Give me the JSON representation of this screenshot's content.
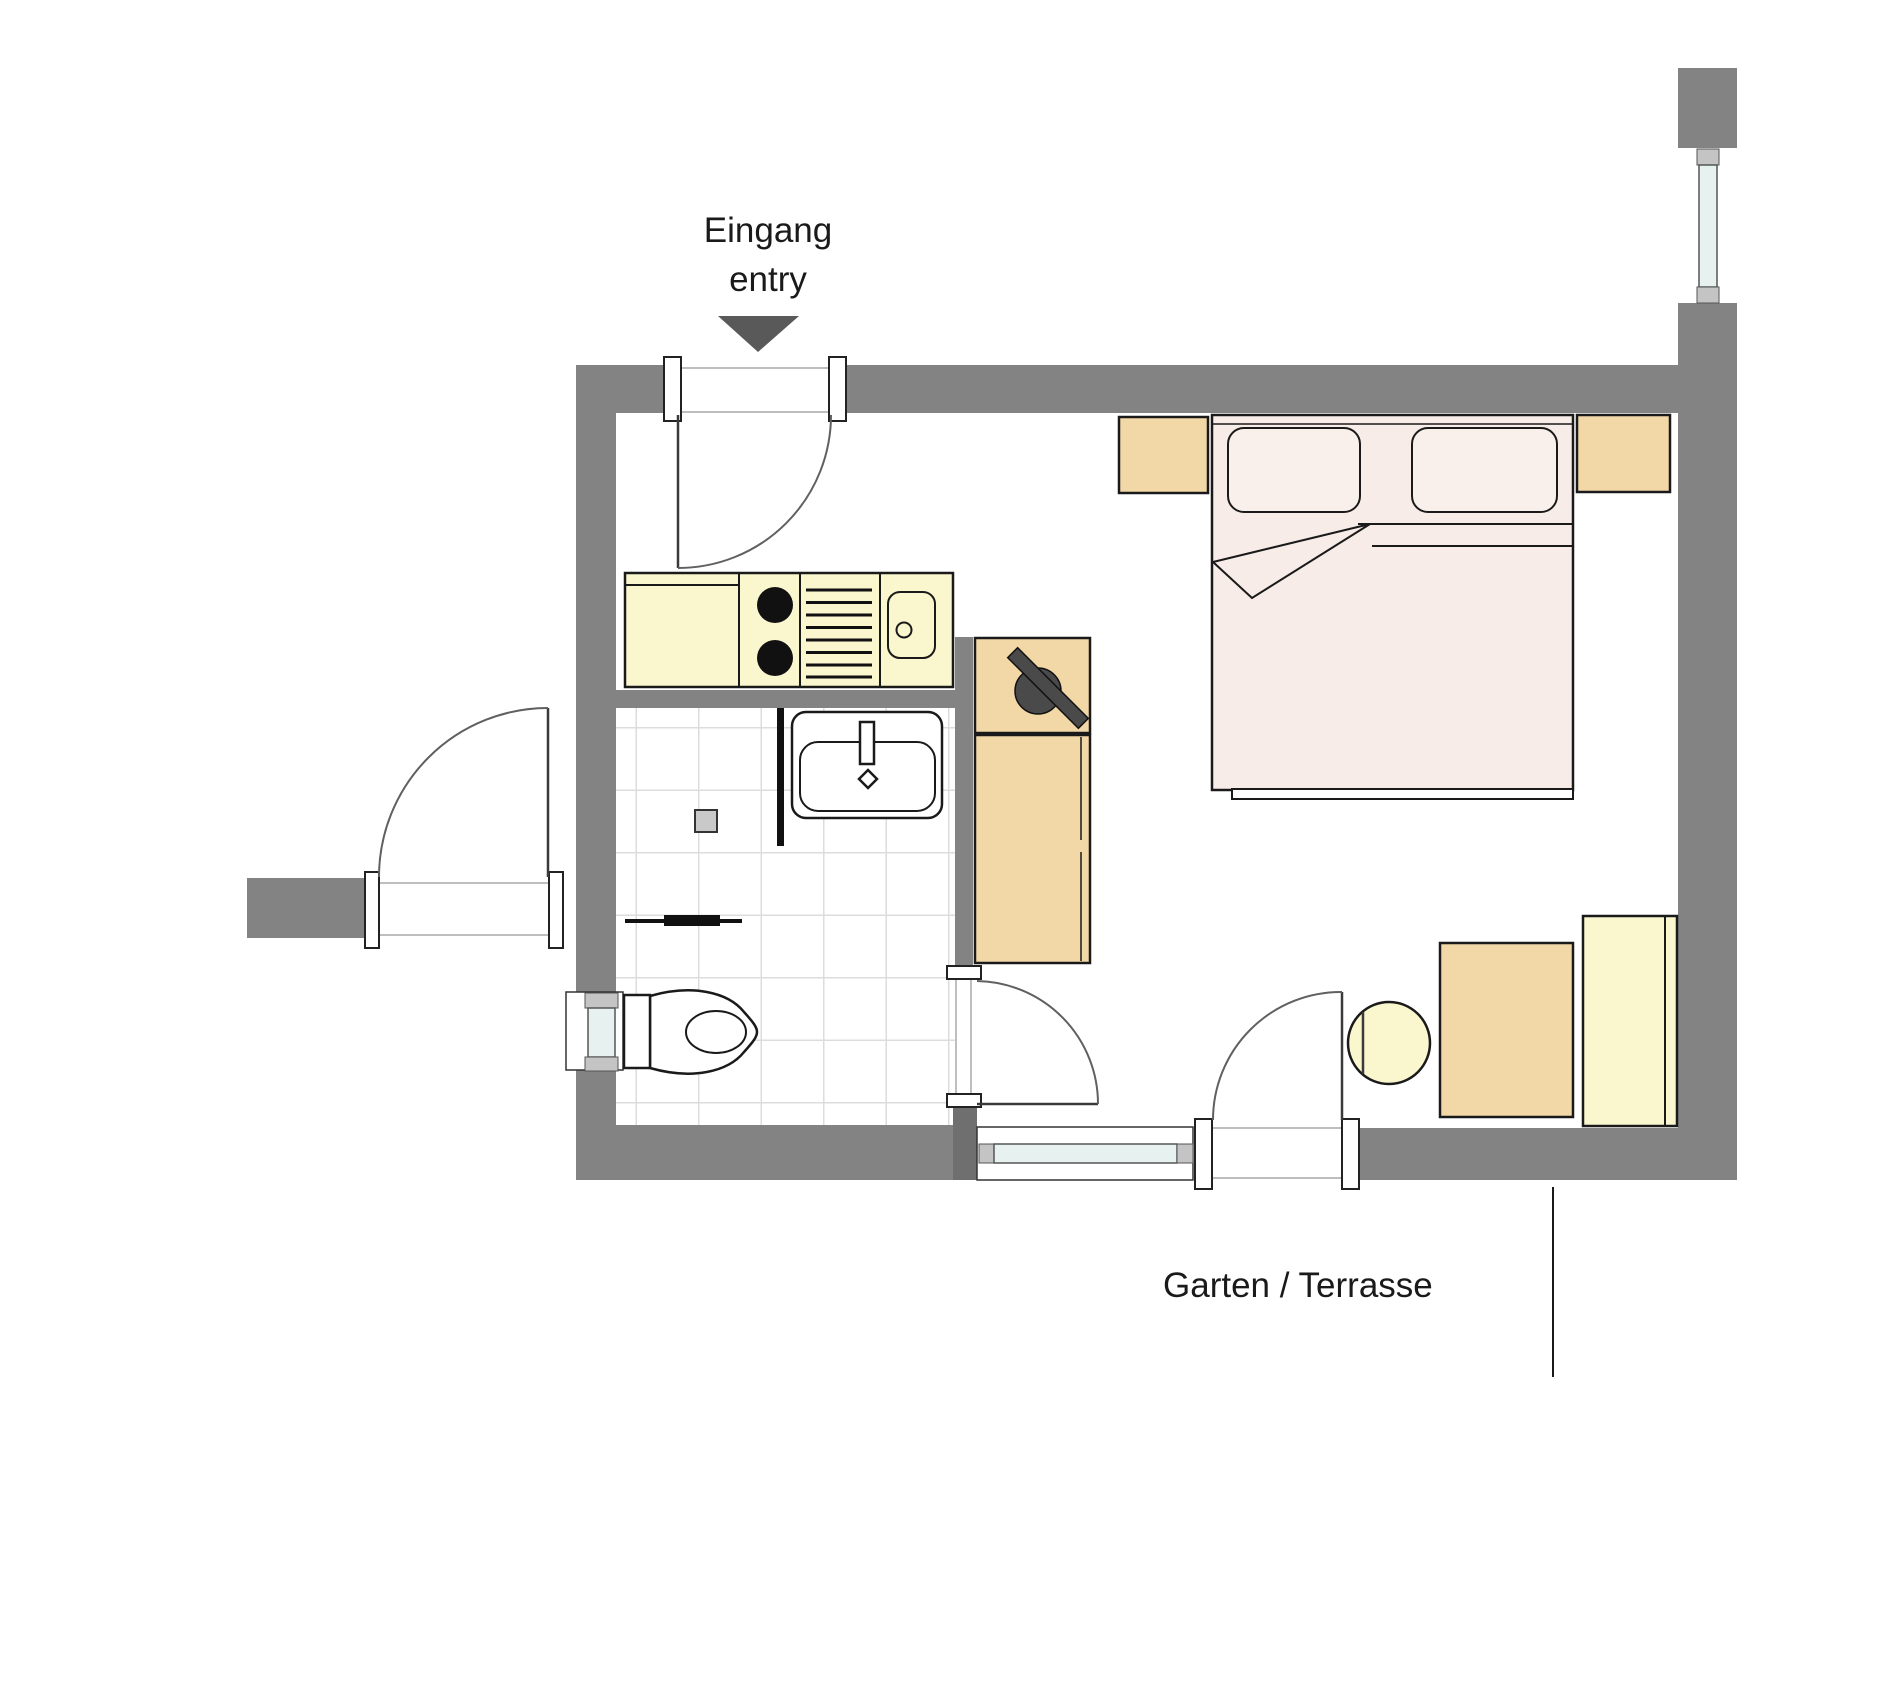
{
  "labels": {
    "entrance_line1": "Eingang",
    "entrance_line2": "entry",
    "garden": "Garten / Terrasse"
  },
  "colors": {
    "wall": "#838383",
    "wall_dark": "#6f6f6f",
    "arrow": "#595959",
    "furniture_tan": "#f2d8a7",
    "kitchen_yellow": "#faf7cf",
    "bed_pink": "#f8ece8",
    "pillow": "#faf0eb",
    "glazing": "#e6f1f0",
    "window_pane_gray": "#c4c4c4",
    "tile_line": "#dcdcdc",
    "outline": "#1a1a1a",
    "swing_arc": "#606060"
  }
}
